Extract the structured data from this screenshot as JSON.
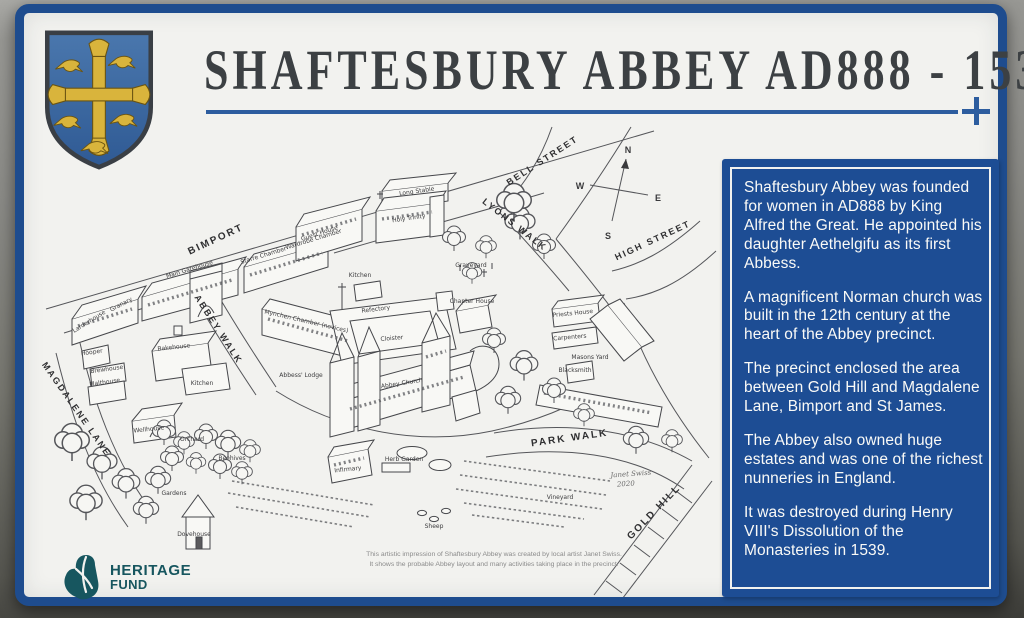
{
  "sign": {
    "title": "SHAFTESBURY ABBEY AD888 - 1539",
    "colors": {
      "border_blue": "#1e4c8e",
      "panel_blue": "#1d4d94",
      "underline_blue": "#2d5d9f",
      "shield_blue": "#3d6aa6",
      "shield_gold": "#d9b43c",
      "logo_teal": "#17565f"
    }
  },
  "panel": {
    "paragraphs": [
      "Shaftesbury Abbey was founded for women in AD888 by King Alfred the Great. He appointed his daughter Aethelgifu as its first Abbess.",
      "A magnificent Norman church was built in the 12th century at the heart of the Abbey precinct.",
      "The precinct enclosed the area between Gold Hill and Magdalene Lane, Bimport and St James.",
      "The Abbey also owned huge estates and was one of the richest nunneries in England.",
      "It was destroyed during Henry VIII's Dissolution of the Monasteries in 1539."
    ]
  },
  "map": {
    "streets": [
      "BIMPORT",
      "BELL STREET",
      "LYONS WALK",
      "HIGH STREET",
      "ABBEY WALK",
      "MAGDALENE LANE",
      "PARK WALK",
      "GOLD HILL"
    ],
    "compass": {
      "n": "N",
      "e": "E",
      "s": "S",
      "w": "W"
    },
    "labels": [
      "Long Stable",
      "Guest House",
      "Holy Trinity",
      "Graveyard",
      "Main Gatehouse",
      "Starre Chamber",
      "Wardrobe Chamber",
      "Granary",
      "Larderhouse",
      "Mynchen Chamber (novices)",
      "Kitchen",
      "Refectory",
      "Cloister",
      "Abbey Church",
      "Chapter House",
      "Abbess' Lodge",
      "Priests House",
      "Carpenters",
      "Masons Yard",
      "Blacksmith",
      "Bakehouse",
      "Hooper",
      "Brewhouse",
      "Malthouse",
      "Kitchen",
      "Wellhouse",
      "Orchard",
      "Beehives",
      "Gardens",
      "Dovehouse",
      "Sheep",
      "Herb Garden",
      "Infirmary",
      "Vineyard"
    ],
    "signature": [
      "Janet Swiss",
      "2020"
    ],
    "caption": [
      "This artistic impression of Shaftesbury Abbey was created by local artist Janet Swiss.",
      "It shows the probable Abbey layout and many activities taking place in the precinct."
    ]
  },
  "logo": {
    "line1": "HERITAGE",
    "line2": "FUND"
  }
}
